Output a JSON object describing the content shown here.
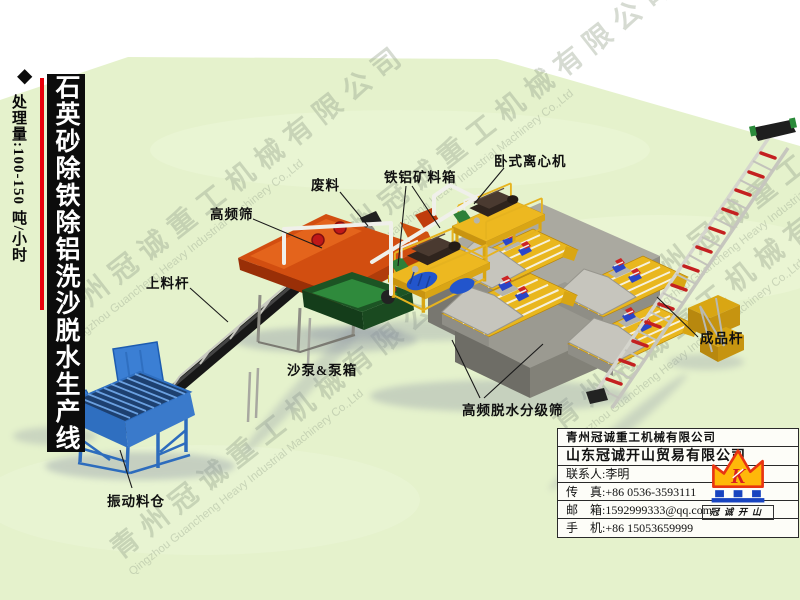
{
  "banner": {
    "diamond": "◆",
    "capacity": "处理量:100-150 吨/小时",
    "title": "石英砂除铁除铝洗沙脱水生产线"
  },
  "watermark": {
    "cn": "青州冠诚重工机械有限公司",
    "en": "Qingzhou Guancheng Heavy Industrial Machinery Co.,Ltd"
  },
  "labels": {
    "feeding_conveyor": "上料杆",
    "high_freq_screen": "高频筛",
    "waste": "废料",
    "ore_box": "铁铝矿料箱",
    "centrifuge": "卧式离心机",
    "sand_pump": "沙泵&泵箱",
    "vibrating_hopper": "振动料仓",
    "dewatering_screen": "高频脱水分级筛",
    "product_conveyor": "成品杆"
  },
  "company": {
    "name_main": "青州冠诚重工机械有限公司",
    "name_trade": "山东冠诚开山贸易有限公司",
    "rows": [
      {
        "label": "联系人:",
        "value": "李明"
      },
      {
        "label": "传　真:",
        "value": "+86 0536-3593111"
      },
      {
        "label": "邮　箱:",
        "value": "1592999333@qq.com"
      },
      {
        "label": "手　机:",
        "value": "+86 15053659999"
      }
    ],
    "logo_letter": "K",
    "logo_text": "冠诚开山"
  },
  "colors": {
    "accent_red": "#e8000a",
    "ground_green": "#e5f2cc",
    "machine_orange": "#d24e10",
    "machine_blue": "#3b7fd4",
    "machine_yellow": "#e9b71e",
    "platform_gray": "#aaa9a0",
    "crown_yellow": "#ffb80a",
    "crown_red": "#e83412",
    "logo_blue": "#1844c0"
  }
}
